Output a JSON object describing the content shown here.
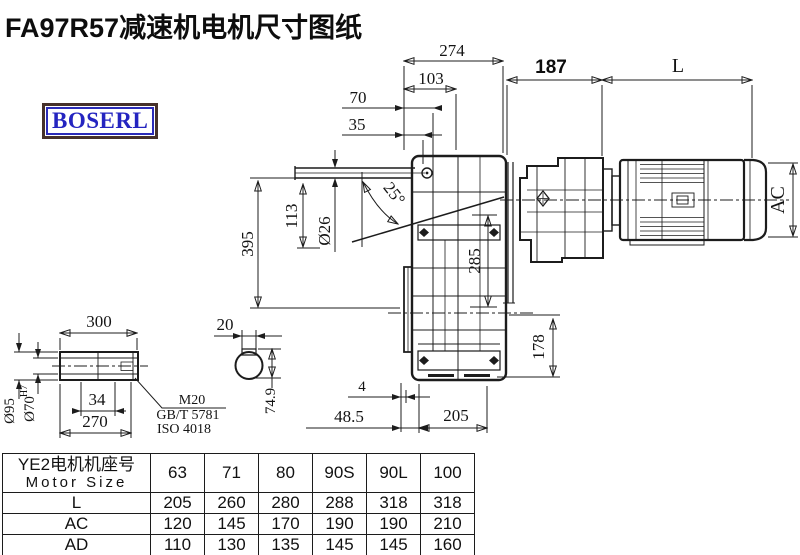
{
  "title": "FA97R57减速机电机尺寸图纸",
  "logo": {
    "text": "BOSERL"
  },
  "drawing": {
    "dims": {
      "d274": "274",
      "d103": "103",
      "d70": "70",
      "d35": "35",
      "d187": "187",
      "dL": "L",
      "dAC": "AC",
      "d395": "395",
      "d113": "113",
      "d26": "Ø26",
      "d25": "25°",
      "d285": "285",
      "d178": "178",
      "d4": "4",
      "d48_5": "48.5",
      "d205": "205",
      "d300": "300",
      "d95": "Ø95",
      "d70h7": "Ø70",
      "d70h7_sup": "H7",
      "d34": "34",
      "d270": "270",
      "m20": "M20",
      "gbt": "GB/T 5781",
      "iso": "ISO 4018",
      "d20": "20",
      "d74_9": "74.9"
    }
  },
  "table": {
    "header_cn": "YE2电机机座号",
    "header_en": "Motor Size",
    "columns": [
      "63",
      "71",
      "80",
      "90S",
      "90L",
      "100"
    ],
    "rows": [
      {
        "label": "L",
        "values": [
          "205",
          "260",
          "280",
          "288",
          "318",
          "318"
        ]
      },
      {
        "label": "AC",
        "values": [
          "120",
          "145",
          "170",
          "190",
          "190",
          "210"
        ]
      },
      {
        "label": "AD",
        "values": [
          "110",
          "130",
          "135",
          "145",
          "145",
          "160"
        ]
      }
    ]
  },
  "colors": {
    "line": "#1c1c1c",
    "logo_border": "#46312a",
    "logo_blue": "#2424c0"
  }
}
